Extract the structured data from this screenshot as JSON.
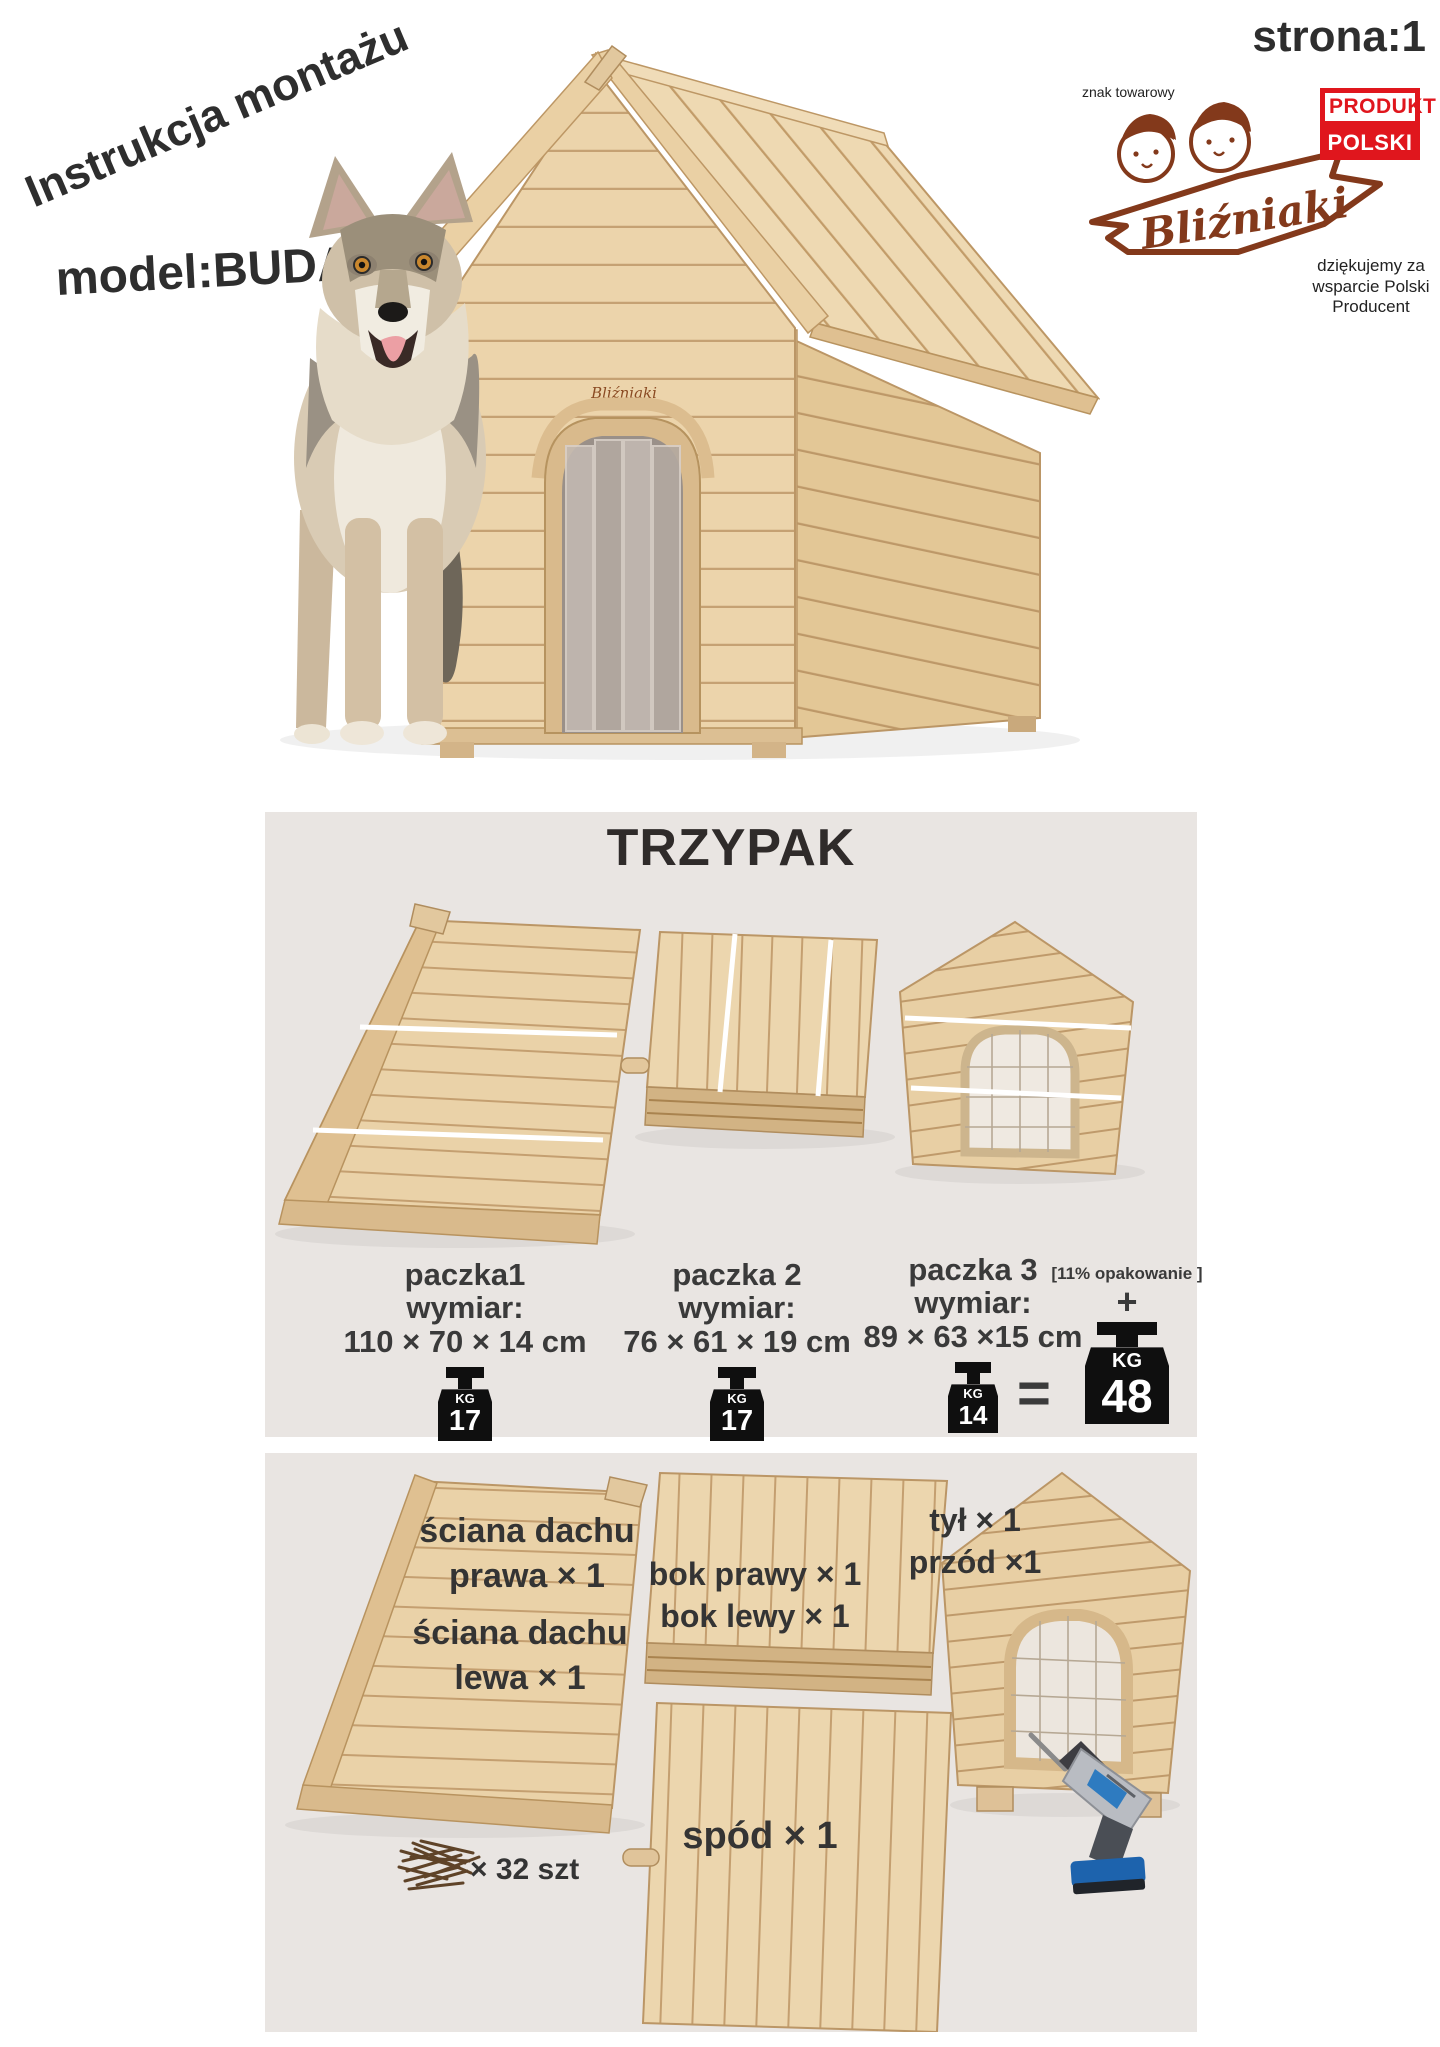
{
  "header": {
    "rotated_title": "Instrukcja montażu",
    "model_label": "model:BUDA2",
    "page_label": "strona:1"
  },
  "brand": {
    "trademark_note": "znak towarowy",
    "logo_text": "Bliźniaki",
    "registered_mark": "®",
    "produkt_badge_line1": "PRODUKT",
    "produkt_badge_line2": "POLSKI",
    "support_note": "dziękujemy za wsparcie Polski Producent"
  },
  "hero": {
    "house_brand_mark": "Bliźniaki"
  },
  "packages_section": {
    "title": "TRZYPAK",
    "packages": [
      {
        "name": "paczka1",
        "dim_label": "wymiar:",
        "dimensions": "110 × 70 × 14 cm",
        "weight_unit": "KG",
        "weight": "17"
      },
      {
        "name": "paczka 2",
        "dim_label": "wymiar:",
        "dimensions": "76 × 61 × 19 cm",
        "weight_unit": "KG",
        "weight": "17"
      },
      {
        "name": "paczka 3",
        "dim_label": "wymiar:",
        "dimensions": "89 × 63 ×15 cm",
        "weight_unit": "KG",
        "weight": "14"
      }
    ],
    "equals_sign": "=",
    "total_note": "[11% opakowanie ]",
    "plus_sign": "+",
    "total_weight_unit": "KG",
    "total_weight": "48"
  },
  "parts_section": {
    "roof_wall_right_line1": "ściana dachu",
    "roof_wall_right_line2": "prawa × 1",
    "roof_wall_left_line1": "ściana dachu",
    "roof_wall_left_line2": "lewa × 1",
    "side_right_label": "bok prawy × 1",
    "side_left_label": "bok lewy × 1",
    "back_label": "tył × 1",
    "front_label": "przód ×1",
    "bottom_label": "spód × 1",
    "screws_label": "× 32 szt"
  },
  "colors": {
    "panel_bg": "#e9e5e2",
    "brand_brown": "#83391b",
    "badge_red": "#e0161d",
    "text_dark": "#333333",
    "weight_icon_bg": "#0f0f0f"
  },
  "icons": {
    "weight": "kettlebell-weight-icon",
    "screws": "screws-pile-icon",
    "drill": "cordless-drill-icon"
  }
}
